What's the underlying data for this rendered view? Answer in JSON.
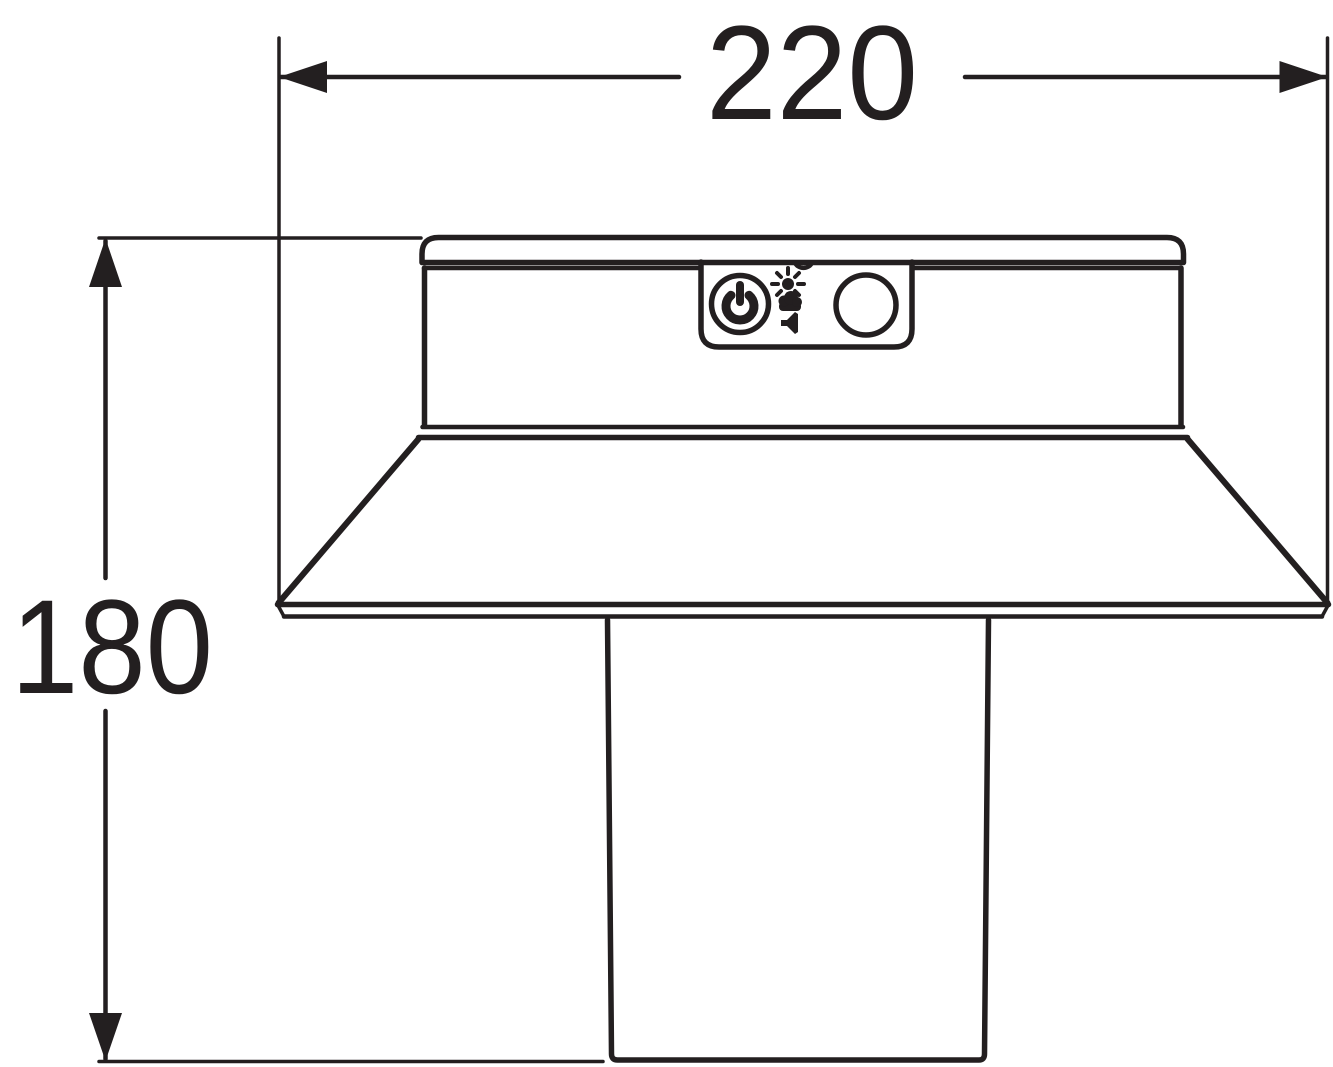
{
  "drawing": {
    "ink_color": "#231f20",
    "paper_color": "#ffffff"
  },
  "dimensions": {
    "width_label": "220",
    "height_label": "180"
  },
  "control_panel": {
    "icons": [
      "power-icon",
      "sun-icon",
      "cloud-icon",
      "sound-icon",
      "sensor-window"
    ]
  }
}
